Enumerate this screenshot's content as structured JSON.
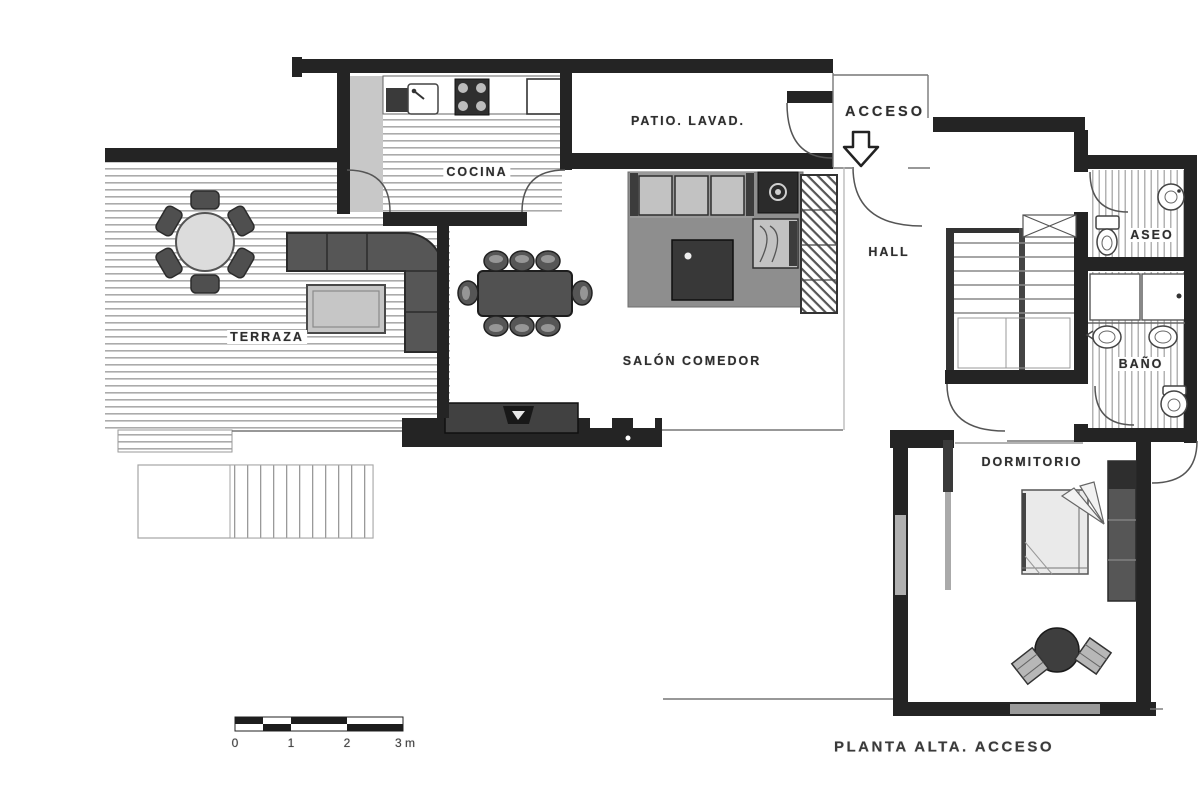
{
  "plan": {
    "title": "PLANTA ALTA. ACCESO",
    "rooms": [
      {
        "id": "cocina",
        "label": "COCINA"
      },
      {
        "id": "patio_lavadero",
        "label": "PATIO. LAVAD."
      },
      {
        "id": "acceso",
        "label": "ACCESO"
      },
      {
        "id": "terraza",
        "label": "TERRAZA"
      },
      {
        "id": "salon_comedor",
        "label": "SALÓN COMEDOR"
      },
      {
        "id": "hall",
        "label": "HALL"
      },
      {
        "id": "aseo",
        "label": "ASEO"
      },
      {
        "id": "bano",
        "label": "BAÑO"
      },
      {
        "id": "dormitorio",
        "label": "DORMITORIO"
      }
    ],
    "scale_bar": {
      "unit_m_ticks": [
        "0",
        "1",
        "2",
        "3 m"
      ]
    },
    "colors": {
      "wall": "#242424",
      "floor_line": "#a6a6a6",
      "furniture_dark": "#4a4a4a",
      "furniture_light": "#c2c2c2",
      "rug": "#8e8e8e",
      "background": "#ffffff"
    }
  }
}
